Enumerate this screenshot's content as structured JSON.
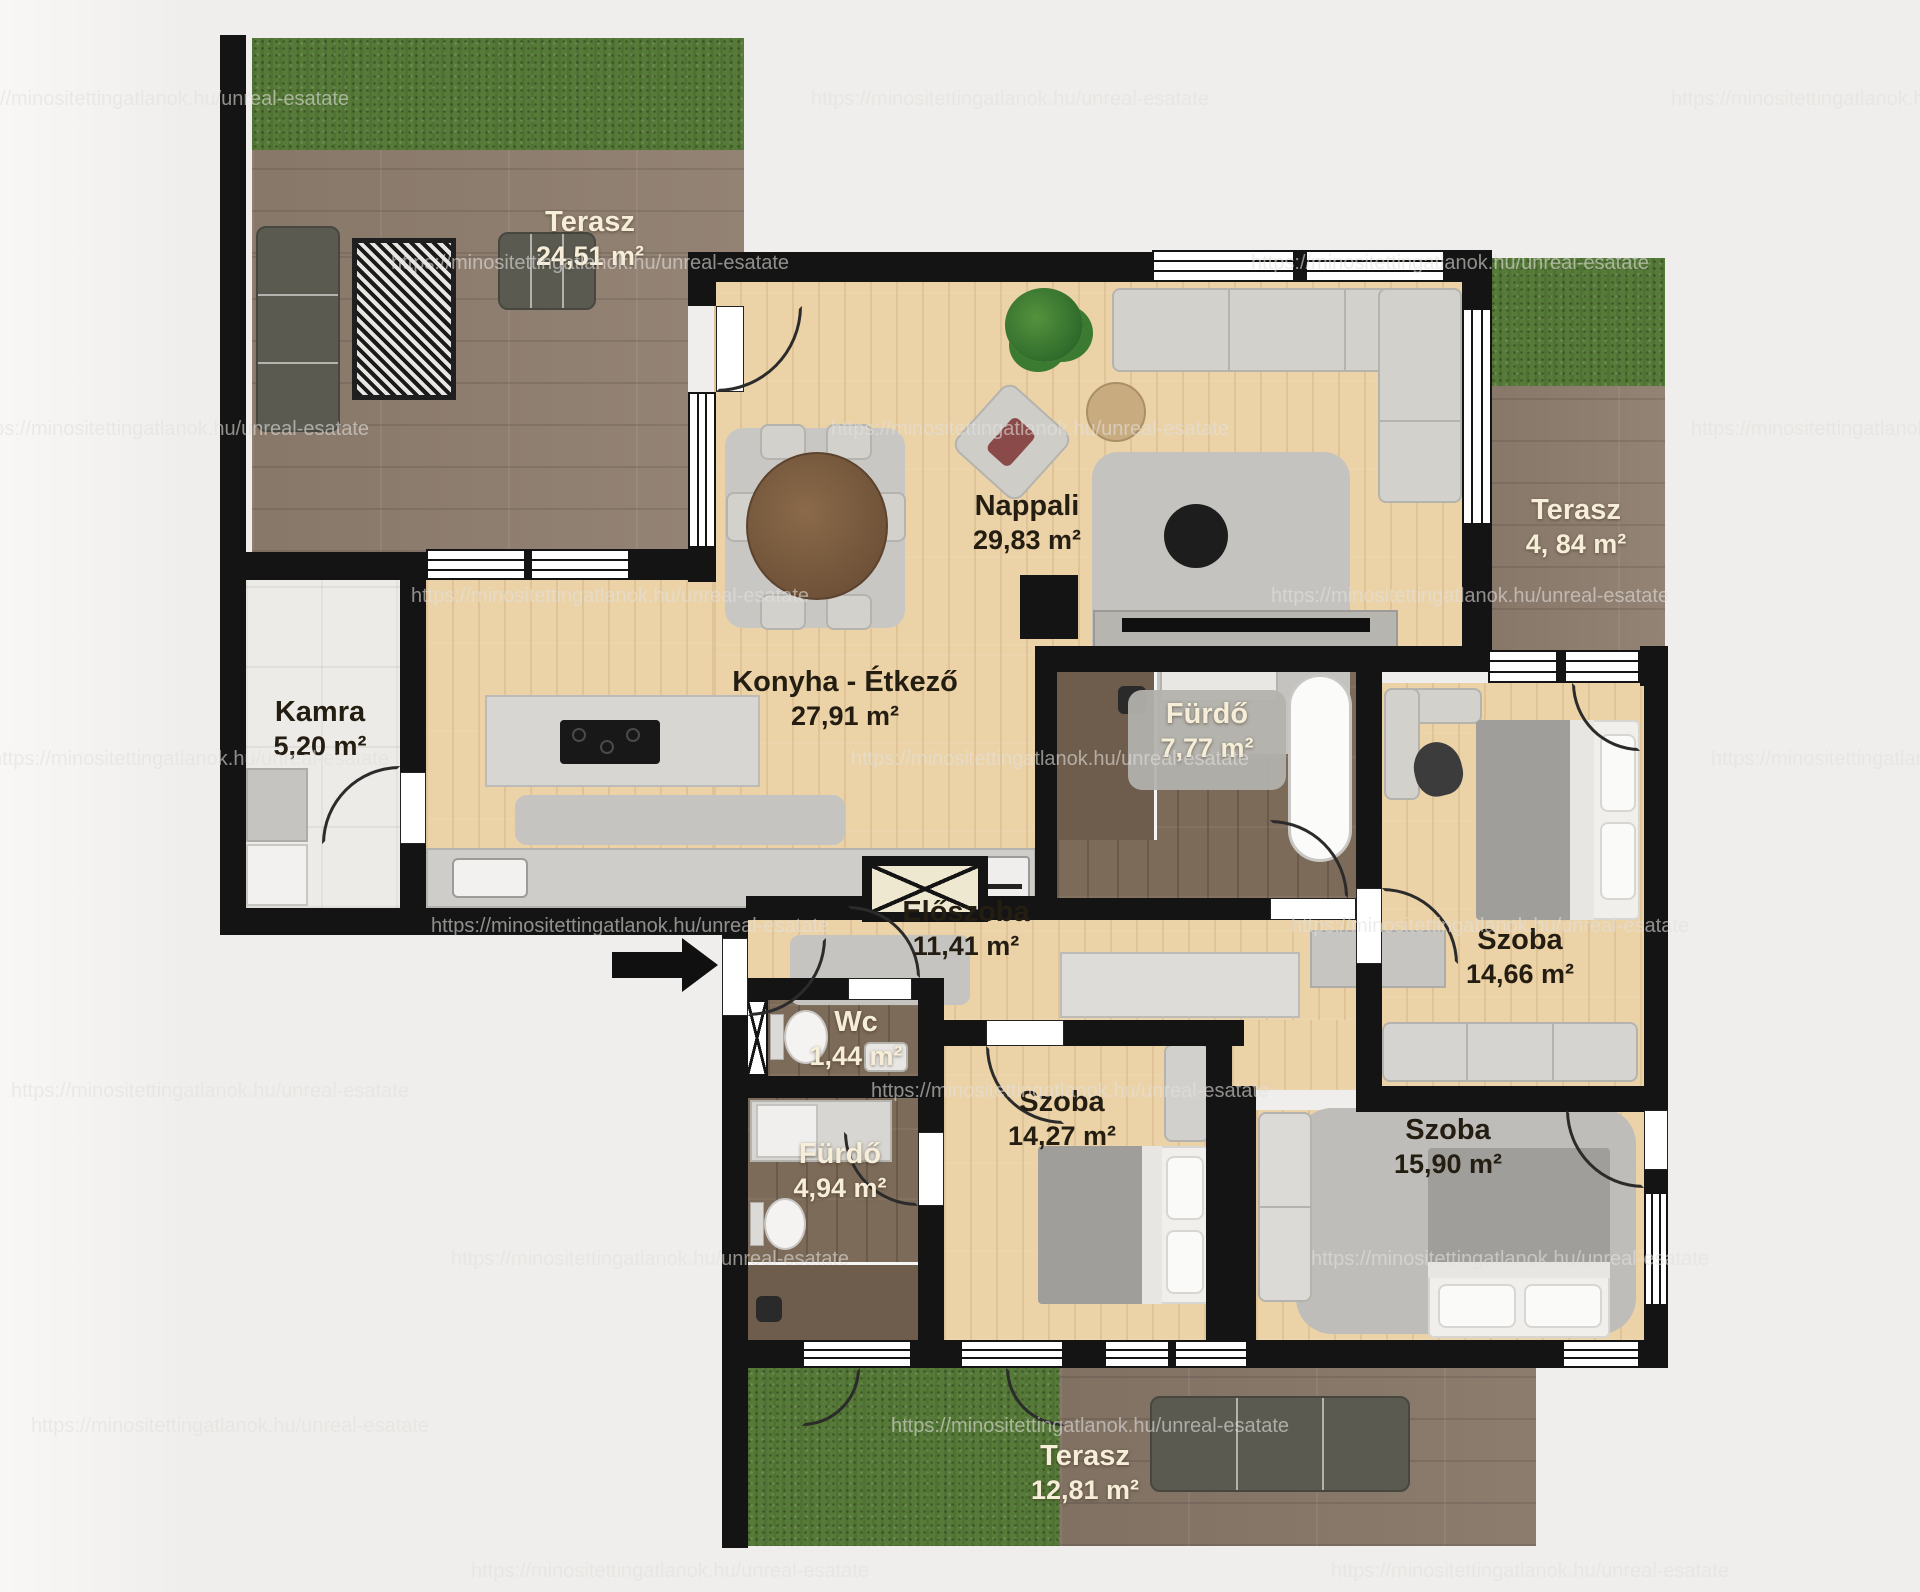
{
  "title": "Apartment floor plan",
  "watermark": {
    "text": "https://minositettingatlanok.hu/unreal-esatate",
    "positions": [
      [
        150,
        88
      ],
      [
        1010,
        88
      ],
      [
        1870,
        88
      ],
      [
        590,
        252
      ],
      [
        1450,
        252
      ],
      [
        170,
        418
      ],
      [
        1030,
        418
      ],
      [
        1890,
        418
      ],
      [
        610,
        585
      ],
      [
        1470,
        585
      ],
      [
        190,
        748
      ],
      [
        1050,
        748
      ],
      [
        1910,
        748
      ],
      [
        630,
        915
      ],
      [
        1490,
        915
      ],
      [
        210,
        1080
      ],
      [
        1070,
        1080
      ],
      [
        650,
        1248
      ],
      [
        1510,
        1248
      ],
      [
        230,
        1415
      ],
      [
        1090,
        1415
      ],
      [
        670,
        1560
      ],
      [
        1530,
        1560
      ]
    ]
  },
  "rooms": {
    "terasz_tl": {
      "name": "Terasz",
      "area": "24,51 m²"
    },
    "nappali": {
      "name": "Nappali",
      "area": "29,83 m²"
    },
    "konyha": {
      "name": "Konyha - Étkező",
      "area": "27,91 m²"
    },
    "kamra": {
      "name": "Kamra",
      "area": "5,20 m²"
    },
    "terasz_r": {
      "name": "Terasz",
      "area": "4, 84 m²"
    },
    "furdo_nagy": {
      "name": "Fürdő",
      "area": "7,77 m²"
    },
    "szoba_jobb": {
      "name": "Szoba",
      "area": "14,66 m²"
    },
    "eloszoba": {
      "name": "Előszoba",
      "area": "11,41 m²"
    },
    "wc": {
      "name": "Wc",
      "area": "1,44 m²"
    },
    "furdo_kis": {
      "name": "Fürdő",
      "area": "4,94 m²"
    },
    "szoba_kozep": {
      "name": "Szoba",
      "area": "14,27 m²"
    },
    "szoba_also": {
      "name": "Szoba",
      "area": "15,90 m²"
    },
    "terasz_also": {
      "name": "Terasz",
      "area": "12,81 m²"
    }
  },
  "colors": {
    "background": "#efeeec",
    "wall": "#141414",
    "floor_wood": "#ebd2a7",
    "floor_dark_wood": "#7d6b59",
    "terrace_deck": "#8f7e6f",
    "grass": "#567a38",
    "kamra_floor": "#edebe7",
    "label_dark": "#241d12",
    "label_light": "#f6eed9",
    "furniture_gray": "#d3d1cc",
    "sofa_green_gray": "#5a5a51"
  }
}
